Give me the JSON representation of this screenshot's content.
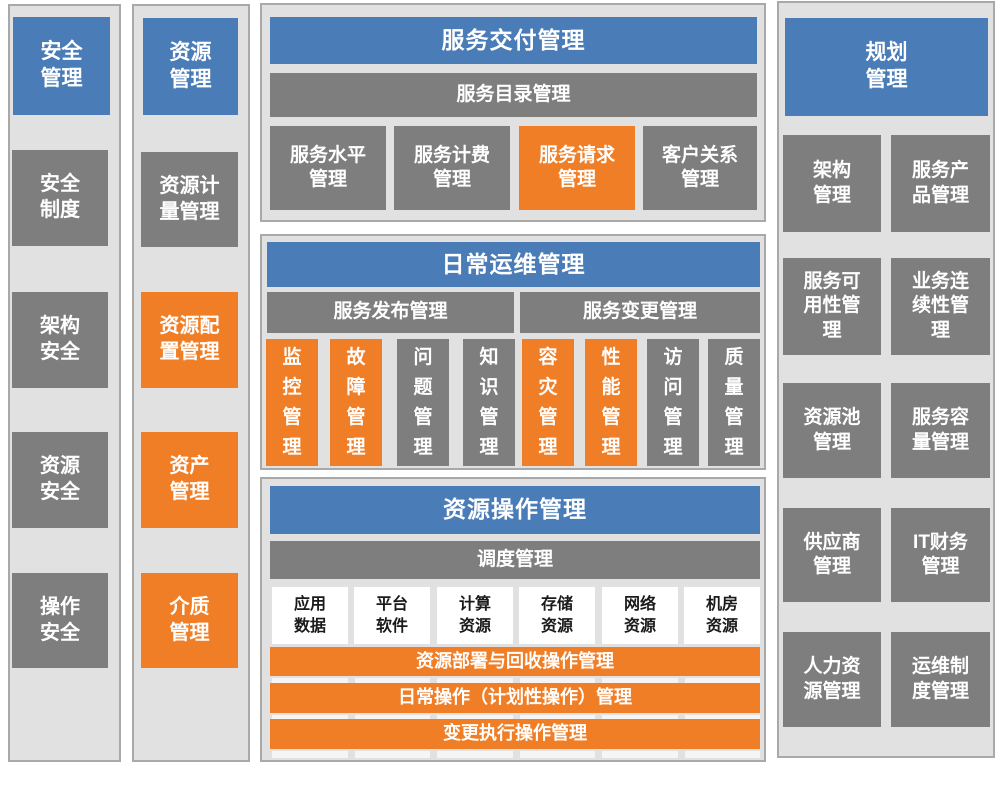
{
  "colors": {
    "header_blue": "#4A7CB8",
    "box_gray": "#7E7E7E",
    "highlight_orange": "#F07E26",
    "container_bg": "#E1E1E1",
    "container_border": "#A9A9A9",
    "light_text": "#FFFFFF",
    "dark_text": "#1A1A1A"
  },
  "security_column": {
    "header": "安全\n管理",
    "items": [
      {
        "label": "安全\n制度",
        "variant": "gray"
      },
      {
        "label": "架构\n安全",
        "variant": "gray"
      },
      {
        "label": "资源\n安全",
        "variant": "gray"
      },
      {
        "label": "操作\n安全",
        "variant": "gray"
      }
    ]
  },
  "resource_column": {
    "header": "资源\n管理",
    "items": [
      {
        "label": "资源计\n量管理",
        "variant": "gray"
      },
      {
        "label": "资源配\n置管理",
        "variant": "orange"
      },
      {
        "label": "资产\n管理",
        "variant": "orange"
      },
      {
        "label": "介质\n管理",
        "variant": "orange"
      }
    ]
  },
  "service_delivery": {
    "header": "服务交付管理",
    "catalog_bar": "服务目录管理",
    "items": [
      {
        "label": "服务水平\n管理",
        "variant": "gray"
      },
      {
        "label": "服务计费\n管理",
        "variant": "gray"
      },
      {
        "label": "服务请求\n管理",
        "variant": "orange"
      },
      {
        "label": "客户关系\n管理",
        "variant": "gray"
      }
    ]
  },
  "daily_operations": {
    "header": "日常运维管理",
    "release_bar": "服务发布管理",
    "change_bar": "服务变更管理",
    "items": [
      {
        "label": "监控管理",
        "variant": "orange"
      },
      {
        "label": "故障管理",
        "variant": "orange"
      },
      {
        "label": "问题管理",
        "variant": "gray"
      },
      {
        "label": "知识管理",
        "variant": "gray"
      },
      {
        "label": "容灾管理",
        "variant": "orange"
      },
      {
        "label": "性能管理",
        "variant": "orange"
      },
      {
        "label": "访问管理",
        "variant": "gray"
      },
      {
        "label": "质量管理",
        "variant": "gray"
      }
    ]
  },
  "resource_operations": {
    "header": "资源操作管理",
    "dispatch_bar": "调度管理",
    "resource_types": [
      {
        "label": "应用\n数据"
      },
      {
        "label": "平台\n软件"
      },
      {
        "label": "计算\n资源"
      },
      {
        "label": "存储\n资源"
      },
      {
        "label": "网络\n资源"
      },
      {
        "label": "机房\n资源"
      }
    ],
    "operation_bars": [
      {
        "label": "资源部署与回收操作管理"
      },
      {
        "label": "日常操作（计划性操作）管理"
      },
      {
        "label": "变更执行操作管理"
      }
    ]
  },
  "planning_column": {
    "header": "规划\n管理",
    "items": [
      {
        "label": "架构\n管理"
      },
      {
        "label": "服务产\n品管理"
      },
      {
        "label": "服务可\n用性管\n理"
      },
      {
        "label": "业务连\n续性管\n理"
      },
      {
        "label": "资源池\n管理"
      },
      {
        "label": "服务容\n量管理"
      },
      {
        "label": "供应商\n管理"
      },
      {
        "label": "IT财务\n管理"
      },
      {
        "label": "人力资\n源管理"
      },
      {
        "label": "运维制\n度管理"
      }
    ]
  }
}
